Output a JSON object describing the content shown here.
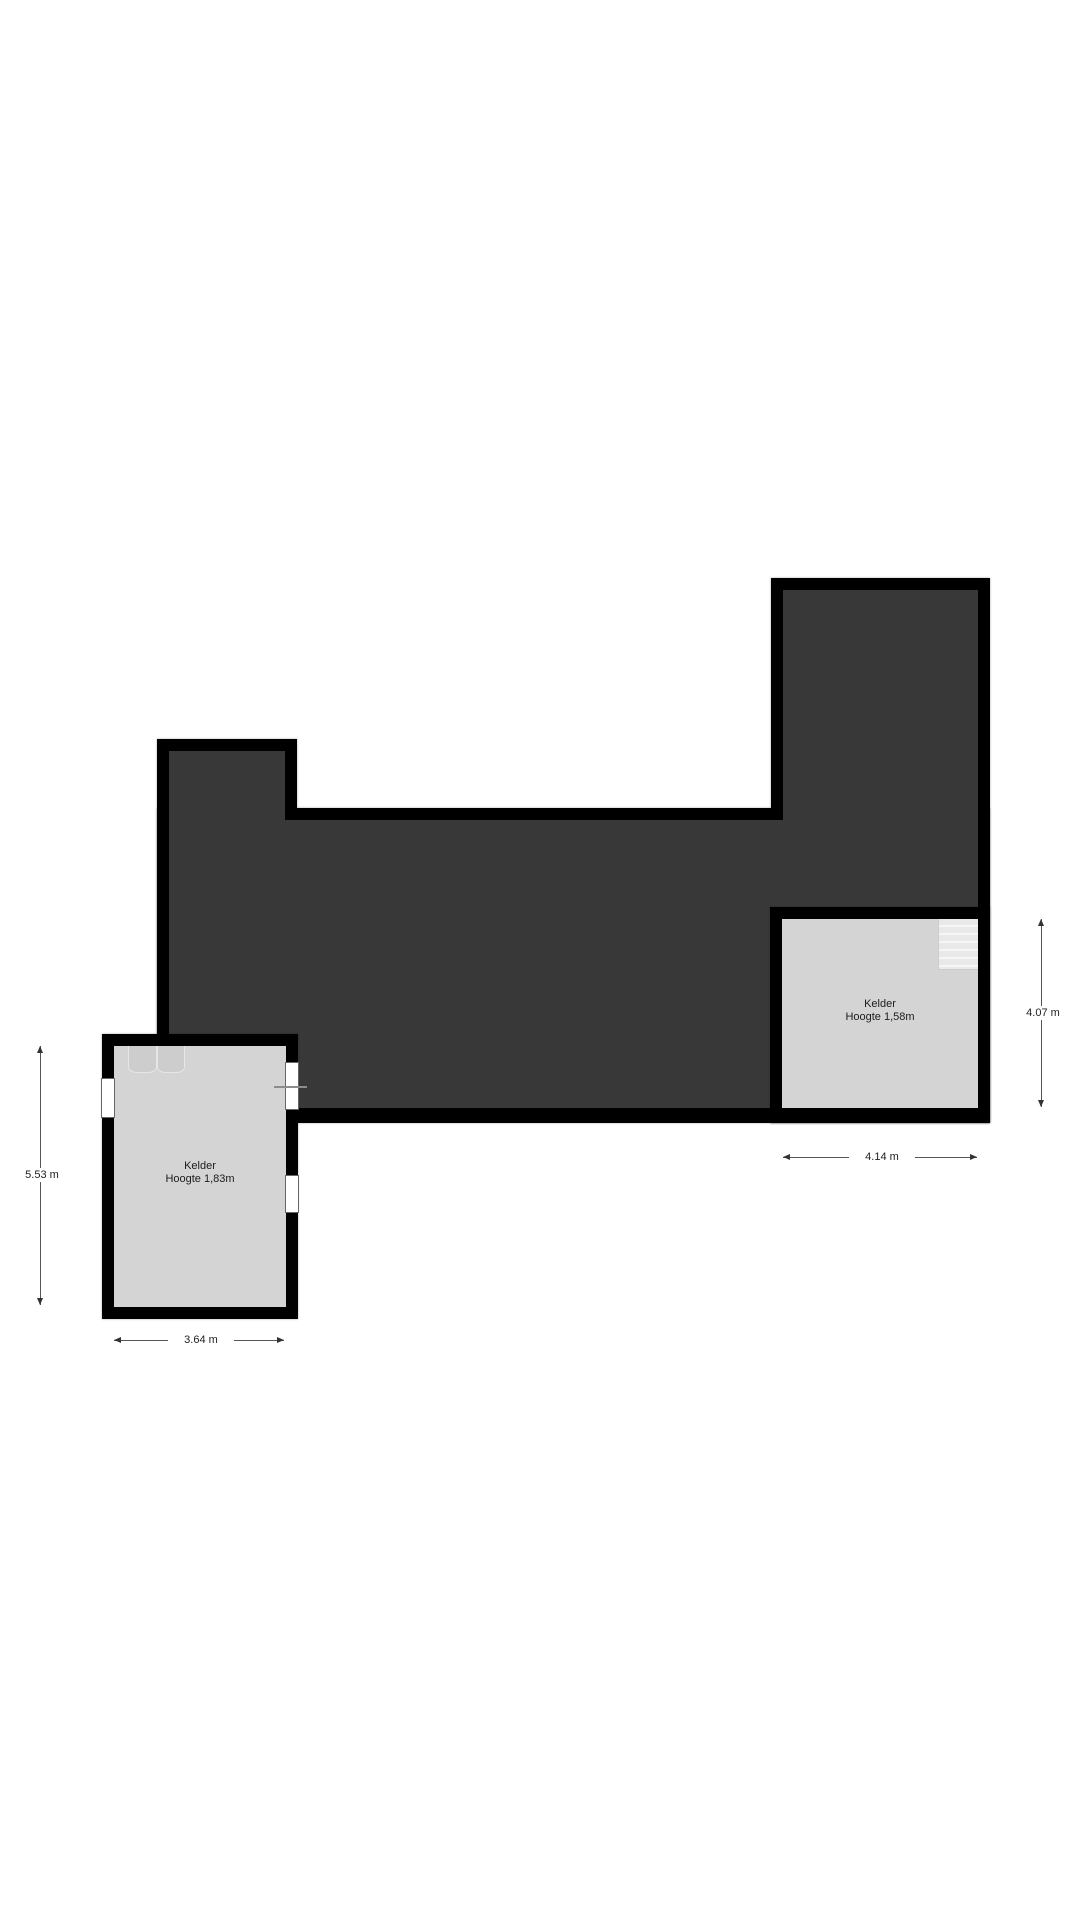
{
  "floorplan": {
    "rooms": [
      {
        "name": "Kelder",
        "height": "Hoogte 1,83m"
      },
      {
        "name": "Kelder",
        "height": "Hoogte 1,58m"
      }
    ],
    "dimensions": [
      {
        "label": "5.53 m",
        "orientation": "vertical",
        "position": "left-room-left-side"
      },
      {
        "label": "3.64 m",
        "orientation": "horizontal",
        "position": "left-room-bottom"
      },
      {
        "label": "4.14 m",
        "orientation": "horizontal",
        "position": "right-room-bottom"
      },
      {
        "label": "4.07 m",
        "orientation": "vertical",
        "position": "right-room-right-side"
      }
    ],
    "colors": {
      "wall": "#000000",
      "dark_area_fill": "#383838",
      "room_fill": "#d4d4d4",
      "background": "#ffffff"
    }
  }
}
